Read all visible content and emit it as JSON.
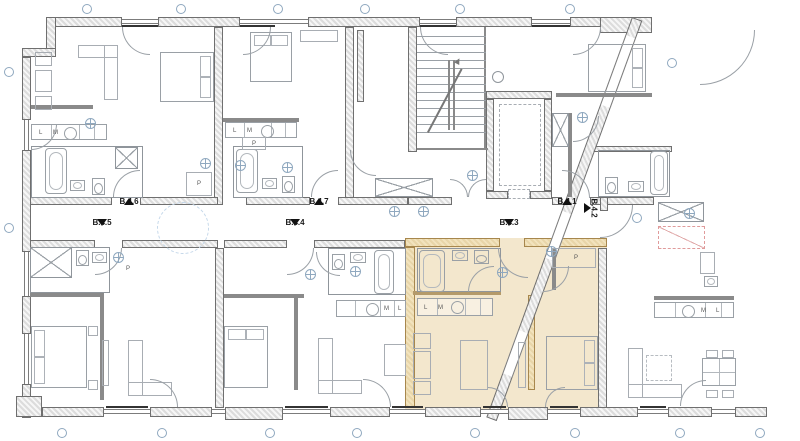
{
  "plan": {
    "units": {
      "u41": "B.4.1",
      "u42": "B.4.2",
      "u43": "B.4.3",
      "u44": "B.4.4",
      "u45": "B.4.5",
      "u46": "B.4.6",
      "u47": "B.4.7"
    },
    "letters": {
      "l": "L",
      "m": "M",
      "p": "P"
    },
    "colors": {
      "highlight": "#f3e7cd",
      "wall_fill": "#dcdcdc",
      "wall_line": "#b0b0b0",
      "tan_wall_fill": "#e8d5a8",
      "tan_wall_line": "#cdab6e",
      "furniture_line": "#9aa0a6",
      "marker_blue": "#8fa8bf",
      "accent_red": "#e09b9b",
      "ink": "#1a1a1a"
    }
  }
}
